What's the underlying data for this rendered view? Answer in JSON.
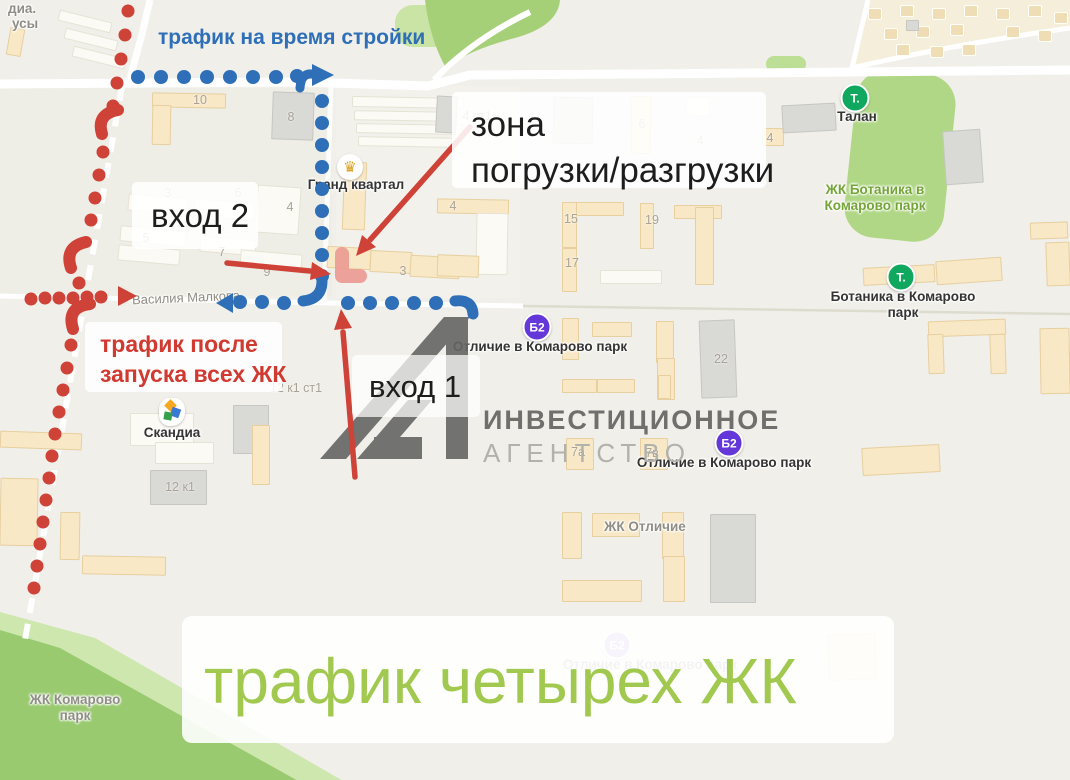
{
  "colors": {
    "blue": "#2e6fb7",
    "red": "#cf4238",
    "red_text": "#d03a31",
    "green_caption": "#a2c94f",
    "map_bg": "#f0efe9",
    "pink_marker": "#eb9b92",
    "watermark_gray": "#656563",
    "poi_green": "#0fa85e",
    "poi_purple": "#6437d9",
    "crown_gold": "#d9a125",
    "park_dark": "#9aca70",
    "park_light": "#cde7ae"
  },
  "annotations": {
    "blue_route_label": "трафик на время стройки",
    "red_route_label_line1": "трафик после",
    "red_route_label_line2": "запуска всех ЖК",
    "entrance1": "вход 1",
    "entrance2": "вход 2",
    "loading_zone_line1": "зона",
    "loading_zone_line2": "погрузки/разгрузки",
    "green_caption": "трафик четырех ЖК"
  },
  "watermark": {
    "line1": "ИНВЕСТИЦИОННОЕ",
    "line2": "АГЕНТСТВО",
    "logo": "А1"
  },
  "map": {
    "pois": [
      {
        "id": "grand-kvartal",
        "icon": "crown",
        "icon_text": "♛",
        "icon_bg": "#ffffff",
        "x": 350,
        "y": 167,
        "lx": 356,
        "ly": 177,
        "style": "black",
        "lines": [
          "Гранд квартал"
        ]
      },
      {
        "id": "talan",
        "icon": "round",
        "icon_text": "Т.",
        "icon_bg": "#0fa85e",
        "x": 855,
        "y": 98,
        "lx": 857,
        "ly": 109,
        "style": "black",
        "lines": [
          "Талан"
        ]
      },
      {
        "id": "botanika-poi",
        "icon": "round",
        "icon_text": "Т.",
        "icon_bg": "#0fa85e",
        "x": 901,
        "y": 277,
        "lx": 903,
        "ly": 289,
        "style": "black",
        "lines": [
          "Ботаника в Комарово",
          "парк"
        ]
      },
      {
        "id": "otlichie-1",
        "icon": "round",
        "icon_text": "Б2",
        "icon_bg": "#6437d9",
        "x": 537,
        "y": 327,
        "lx": 540,
        "ly": 339,
        "style": "black",
        "lines": [
          "Отличие в Комарово парк"
        ]
      },
      {
        "id": "otlichie-2",
        "icon": "round",
        "icon_text": "Б2",
        "icon_bg": "#6437d9",
        "x": 729,
        "y": 443,
        "lx": 724,
        "ly": 455,
        "style": "black",
        "lines": [
          "Отличие в Комарово парк"
        ]
      },
      {
        "id": "otlichie-faded",
        "icon": "round",
        "icon_text": "Б2",
        "icon_bg": "#6437d9",
        "x": 617,
        "y": 645,
        "lx": 650,
        "ly": 657,
        "style": "black faded",
        "faded": true,
        "lines": [
          "Отличие в Комарово парк"
        ]
      },
      {
        "id": "skandia",
        "icon": "skandia",
        "icon_text": "",
        "icon_bg": "#ffffff",
        "x": 172,
        "y": 412,
        "lx": 172,
        "ly": 425,
        "style": "black",
        "lines": [
          "Скандиа"
        ]
      }
    ],
    "labels": [
      {
        "id": "botanika-complex",
        "style": "green",
        "x": 875,
        "y": 182,
        "lines": [
          "ЖК Ботаника в",
          "Комарово парк"
        ]
      },
      {
        "id": "zhk-otlichie",
        "style": "gray",
        "x": 645,
        "y": 519,
        "lines": [
          "ЖК Отличие"
        ]
      },
      {
        "id": "zhk-komarovo",
        "style": "gray",
        "x": 75,
        "y": 692,
        "lines": [
          "ЖК Комарово",
          "парк"
        ]
      },
      {
        "id": "street-vasiliya-malkova",
        "style": "street",
        "x": 186,
        "y": 290,
        "lines": [
          "Василия Малкова"
        ]
      },
      {
        "id": "edge-label-1",
        "style": "gray edge",
        "x": 8,
        "y": 1,
        "lines": [
          "диа."
        ]
      },
      {
        "id": "edge-label-2",
        "style": "gray edge",
        "x": 12,
        "y": 16,
        "lines": [
          "усы"
        ]
      }
    ],
    "building_numbers": [
      {
        "t": "10",
        "x": 200,
        "y": 100
      },
      {
        "t": "8",
        "x": 291,
        "y": 117
      },
      {
        "t": "3",
        "x": 168,
        "y": 193
      },
      {
        "t": "6",
        "x": 238,
        "y": 193
      },
      {
        "t": "4",
        "x": 290,
        "y": 207
      },
      {
        "t": "5",
        "x": 146,
        "y": 238
      },
      {
        "t": "7",
        "x": 222,
        "y": 252
      },
      {
        "t": "9",
        "x": 267,
        "y": 272
      },
      {
        "t": "3",
        "x": 403,
        "y": 271
      },
      {
        "t": "4 ст1",
        "x": 477,
        "y": 116
      },
      {
        "t": "6",
        "x": 642,
        "y": 124
      },
      {
        "t": "4",
        "x": 700,
        "y": 141
      },
      {
        "t": "4",
        "x": 770,
        "y": 138
      },
      {
        "t": "4",
        "x": 453,
        "y": 206
      },
      {
        "t": "15",
        "x": 571,
        "y": 219
      },
      {
        "t": "19",
        "x": 652,
        "y": 220
      },
      {
        "t": "17",
        "x": 572,
        "y": 263
      },
      {
        "t": "22",
        "x": 721,
        "y": 359
      },
      {
        "t": "7а",
        "x": 578,
        "y": 452
      },
      {
        "t": "7в",
        "x": 652,
        "y": 453
      },
      {
        "t": "12 к1 ст1",
        "x": 296,
        "y": 388
      },
      {
        "t": "12 к1",
        "x": 180,
        "y": 487
      }
    ]
  },
  "routes": {
    "blue_dots": [
      [
        138,
        77
      ],
      [
        161,
        77
      ],
      [
        184,
        77
      ],
      [
        207,
        77
      ],
      [
        230,
        77
      ],
      [
        253,
        77
      ],
      [
        276,
        77
      ],
      [
        297,
        76
      ],
      [
        322,
        101
      ],
      [
        322,
        123
      ],
      [
        322,
        145
      ],
      [
        322,
        167
      ],
      [
        322,
        189
      ],
      [
        322,
        211
      ],
      [
        322,
        233
      ],
      [
        322,
        255
      ],
      [
        322,
        276
      ],
      [
        240,
        302
      ],
      [
        262,
        302
      ],
      [
        284,
        303
      ],
      [
        348,
        303
      ],
      [
        370,
        303
      ],
      [
        392,
        303
      ],
      [
        414,
        303
      ],
      [
        436,
        303
      ]
    ],
    "red_dots": [
      [
        128,
        11
      ],
      [
        125,
        35
      ],
      [
        121,
        59
      ],
      [
        117,
        83
      ],
      [
        113,
        106
      ],
      [
        103,
        152
      ],
      [
        99,
        175
      ],
      [
        95,
        198
      ],
      [
        91,
        220
      ],
      [
        79,
        283
      ],
      [
        71,
        345
      ],
      [
        67,
        368
      ],
      [
        63,
        390
      ],
      [
        59,
        412
      ],
      [
        55,
        434
      ],
      [
        52,
        456
      ],
      [
        49,
        478
      ],
      [
        46,
        500
      ],
      [
        43,
        522
      ],
      [
        40,
        544
      ],
      [
        37,
        566
      ],
      [
        34,
        588
      ],
      [
        31,
        299
      ],
      [
        45,
        298
      ],
      [
        59,
        298
      ],
      [
        73,
        298
      ],
      [
        87,
        297
      ],
      [
        101,
        297
      ]
    ]
  }
}
